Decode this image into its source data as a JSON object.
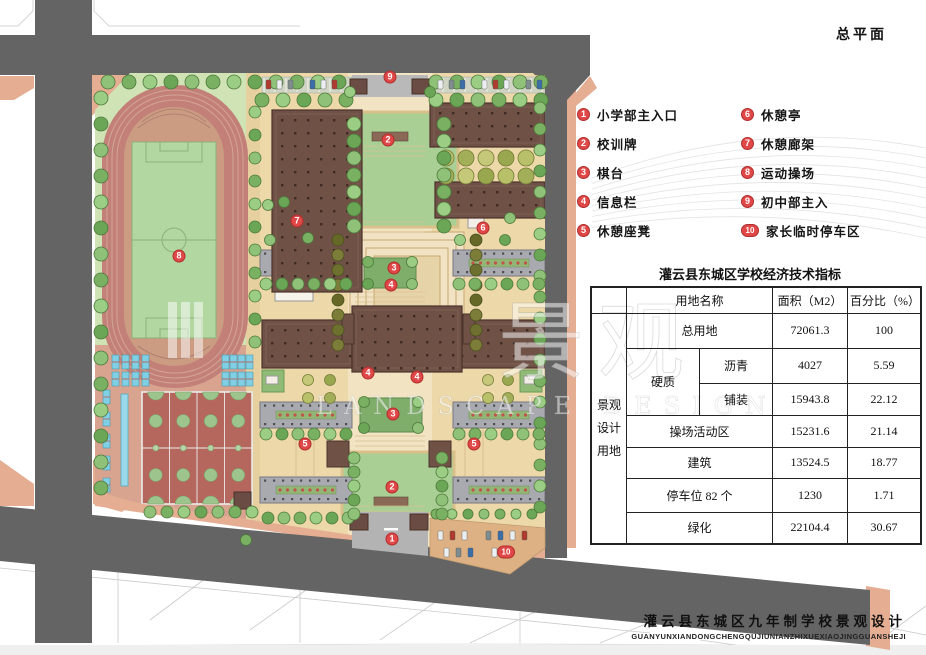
{
  "page_title": "总平面",
  "legend": {
    "items": [
      {
        "num": "1",
        "label": "小学部主入口"
      },
      {
        "num": "2",
        "label": "校训牌"
      },
      {
        "num": "3",
        "label": "棋台"
      },
      {
        "num": "4",
        "label": "信息栏"
      },
      {
        "num": "5",
        "label": "休憩座凳"
      },
      {
        "num": "6",
        "label": "休憩亭"
      },
      {
        "num": "7",
        "label": "休憩廊架"
      },
      {
        "num": "8",
        "label": "运动操场"
      },
      {
        "num": "9",
        "label": "初中部主入"
      },
      {
        "num": "10",
        "label": "家长临时停车区"
      }
    ]
  },
  "table": {
    "title": "灌云县东城区学校经济技术指标",
    "side_header": "景观设计用地",
    "columns": {
      "name": "用地名称",
      "area": "面积（M2）",
      "pct": "百分比（%）"
    },
    "rows": [
      {
        "name": "总用地",
        "area": "72061.3",
        "pct": "100"
      },
      {
        "group": "硬质",
        "name": "沥青",
        "area": "4027",
        "pct": "5.59"
      },
      {
        "group": "硬质",
        "name": "铺装",
        "area": "15943.8",
        "pct": "22.12"
      },
      {
        "name": "操场活动区",
        "area": "15231.6",
        "pct": "21.14"
      },
      {
        "name": "建筑",
        "area": "13524.5",
        "pct": "18.77"
      },
      {
        "name": "停车位 82 个",
        "area": "1230",
        "pct": "1.71"
      },
      {
        "name": "绿化",
        "area": "22104.4",
        "pct": "30.67"
      }
    ]
  },
  "footer": {
    "title": "灌云县东城区九年制学校景观设计",
    "pinyin": "GUANYUNXIANDONGCHENGQUJIUNIANZHIXUEXIAOJINGGUANSHEJI"
  },
  "watermark": {
    "cjk": "景观",
    "latin": "LANDSCAPE DESIGN"
  },
  "plan": {
    "markers": [
      {
        "num": "9",
        "x": 390,
        "y": 77
      },
      {
        "num": "2",
        "x": 388,
        "y": 140
      },
      {
        "num": "7",
        "x": 297,
        "y": 221
      },
      {
        "num": "6",
        "x": 483,
        "y": 228
      },
      {
        "num": "8",
        "x": 179,
        "y": 256
      },
      {
        "num": "3",
        "x": 394,
        "y": 268
      },
      {
        "num": "4",
        "x": 391,
        "y": 285
      },
      {
        "num": "4",
        "x": 368,
        "y": 373
      },
      {
        "num": "4",
        "x": 417,
        "y": 377
      },
      {
        "num": "3",
        "x": 393,
        "y": 414
      },
      {
        "num": "5",
        "x": 305,
        "y": 444
      },
      {
        "num": "5",
        "x": 474,
        "y": 444
      },
      {
        "num": "2",
        "x": 392,
        "y": 487
      },
      {
        "num": "1",
        "x": 392,
        "y": 539
      },
      {
        "num": "10",
        "x": 506,
        "y": 552
      }
    ]
  },
  "colors": {
    "road": "#646464",
    "sidewalk": "#e5ad92",
    "lawn": "#cfe3b4",
    "ground_tan": "#ecd8a9",
    "axis": "#f2e4c2",
    "plaza_green": "#a9cf94",
    "track": "#c28078",
    "field": "#b2d7a0",
    "court": "#b5675e",
    "building": "#6f5146",
    "slab": "#a9a9b0",
    "water": "#7fd0e4",
    "marker_red": "#e04848",
    "tree_green": "#79b062"
  }
}
